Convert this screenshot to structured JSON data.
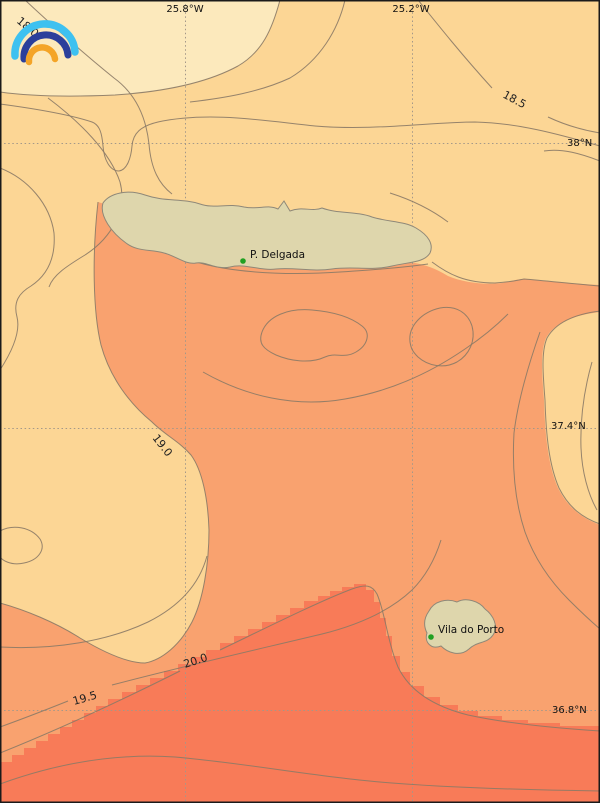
{
  "graticule": {
    "meridians": [
      {
        "label": "25.8°W"
      },
      {
        "label": "25.2°W"
      }
    ],
    "parallels": [
      {
        "label": "38°N"
      },
      {
        "label": "37.4°N"
      },
      {
        "label": "36.8°N"
      }
    ]
  },
  "places": [
    {
      "name": "P. Delgada"
    },
    {
      "name": "Vila do Porto"
    }
  ],
  "isotherm_labels": [
    {
      "text": "18.0"
    },
    {
      "text": "18.5"
    },
    {
      "text": "19.0"
    },
    {
      "text": "19.5"
    },
    {
      "text": "20.0"
    }
  ],
  "colors": {
    "sea_cream": "#fce9bc",
    "sea_yellow": "#fcd695",
    "sea_orange": "#f9a26f",
    "sea_red": "#f87b58",
    "land": "#ded6ac",
    "contour": "#8b7a66",
    "grid": "#a39889",
    "text": "#1a1a1a",
    "marker": "#22a022",
    "logo_light_blue": "#3ec1f0",
    "logo_dark_blue": "#2b3f9b",
    "logo_orange": "#f4a427",
    "frame": "#1a1a1a"
  }
}
